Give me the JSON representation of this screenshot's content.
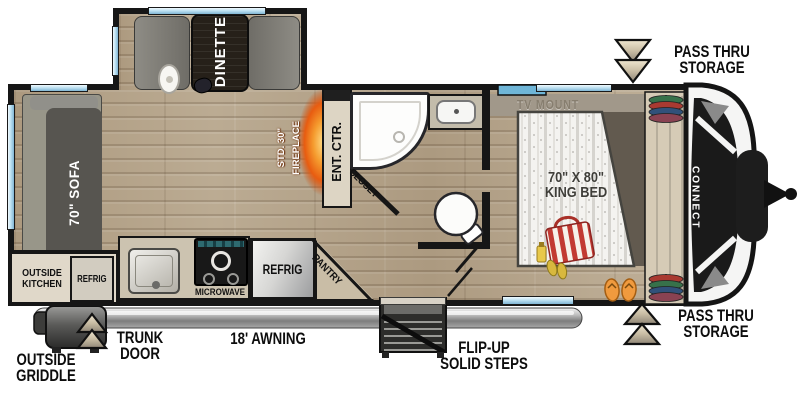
{
  "title": "travel trailer floor plan",
  "labels": {
    "dinette": "DINETTE",
    "sofa": "70\" SOFA",
    "outside_kitchen": [
      "OUTSIDE",
      "KITCHEN"
    ],
    "outside_refrig": "REFRIG",
    "microwave": "MICROWAVE",
    "refrig": "REFRIG",
    "pantry": "PANTRY",
    "fireplace": [
      "STD. 30\"",
      "FIREPLACE"
    ],
    "ent_ctr": "ENT. CTR.",
    "closet": "CLOSET",
    "tv_mount": "TV MOUNT",
    "king_bed": [
      "70\" X 80\"",
      "KING BED"
    ],
    "brand": "CONNECT"
  },
  "annotations": {
    "pass_thru_top": [
      "PASS THRU",
      "STORAGE"
    ],
    "pass_thru_bottom": [
      "PASS THRU",
      "STORAGE"
    ],
    "trunk_door": [
      "TRUNK",
      "DOOR"
    ],
    "awning": "18' AWNING",
    "flip_up_steps": [
      "FLIP-UP",
      "SOLID STEPS"
    ],
    "outside_griddle": [
      "OUTSIDE",
      "GRIDDLE"
    ]
  },
  "icons": {
    "pass_thru_top_arrow": "chevron-down",
    "pass_thru_bottom_arrow": "chevron-up",
    "trunk_door_arrow": "chevron-up"
  },
  "colors": {
    "wall": "#161616",
    "floor_wood": "#b7a68c",
    "window_blue": "#9fd0e8",
    "flame_accent": "#e8641a",
    "upholstery_gray": "#575550",
    "annotation_text": "#0d0d0d",
    "mattress_white": "#f4f3f0",
    "bag_red": "#b03030"
  }
}
